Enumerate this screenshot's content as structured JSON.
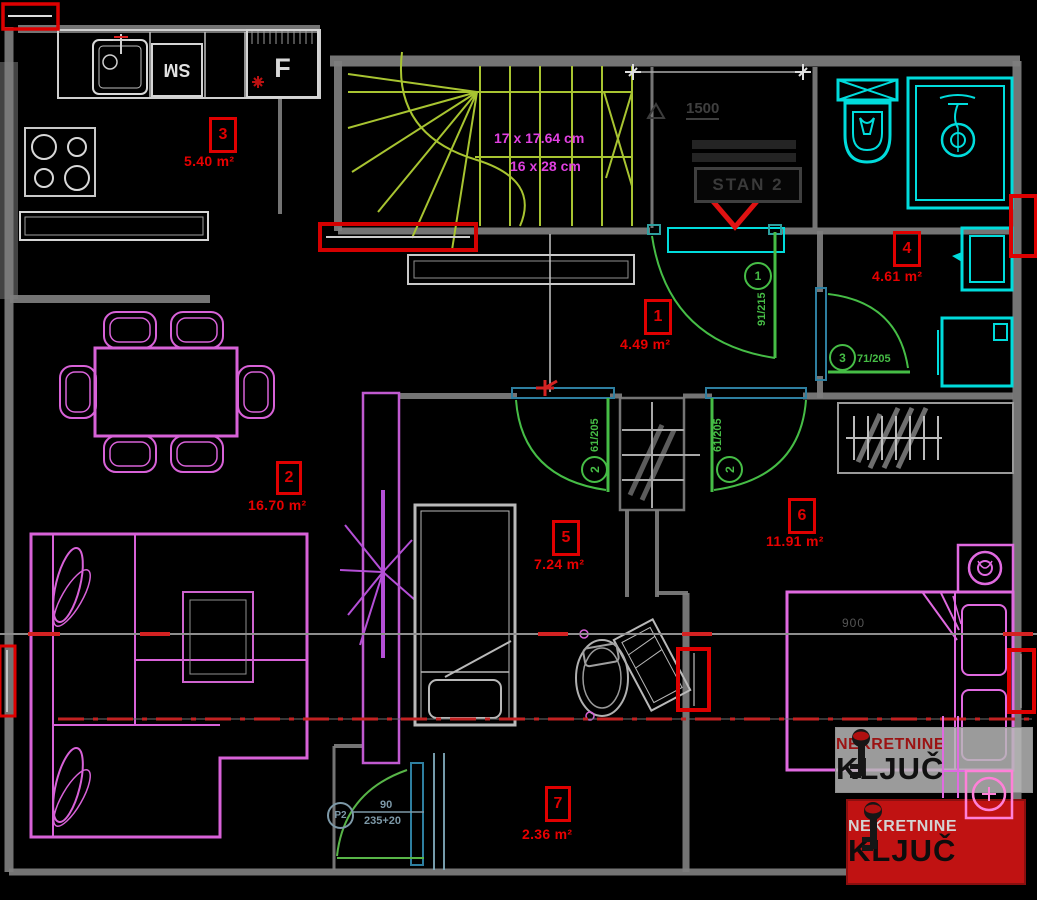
{
  "plan": {
    "rooms": [
      {
        "number": "1",
        "area": "4.49 m²"
      },
      {
        "number": "2",
        "area": "16.70 m²"
      },
      {
        "number": "3",
        "area": "5.40 m²"
      },
      {
        "number": "4",
        "area": "4.61 m²"
      },
      {
        "number": "5",
        "area": "7.24 m²"
      },
      {
        "number": "6",
        "area": "11.91 m²"
      },
      {
        "number": "7",
        "area": "2.36 m²"
      }
    ],
    "stairs": {
      "dim_line1": "17 x 17.64 cm",
      "dim_line2": "16 x 28 cm"
    },
    "doors": {
      "door1": {
        "tag": "1",
        "size": "91/215"
      },
      "door2a": {
        "tag": "2",
        "size": "61/205"
      },
      "door2b": {
        "tag": "2",
        "size": "61/205"
      },
      "door3": {
        "tag": "3",
        "size": "71/205"
      },
      "balcony_door": {
        "tag": "P2",
        "width": "90",
        "height": "235+20"
      }
    },
    "kitchen": {
      "appliance_sm": "SM",
      "appliance_f": "F"
    },
    "entry": {
      "dim": "1500",
      "unit_box": "STAN 2"
    },
    "bedroom": {
      "dim": "900"
    }
  },
  "watermark": {
    "line1": "NEKRETNINE",
    "line2": "KLJUČ"
  },
  "colors": {
    "label_red": "#e80000",
    "door_green": "#46bd46",
    "stair_green": "#a8c431",
    "fixture_cyan": "#00dcdc",
    "furniture_magenta": "#d862d8",
    "wall_gray": "#7e7e7e",
    "logo_red": "#c01212"
  }
}
